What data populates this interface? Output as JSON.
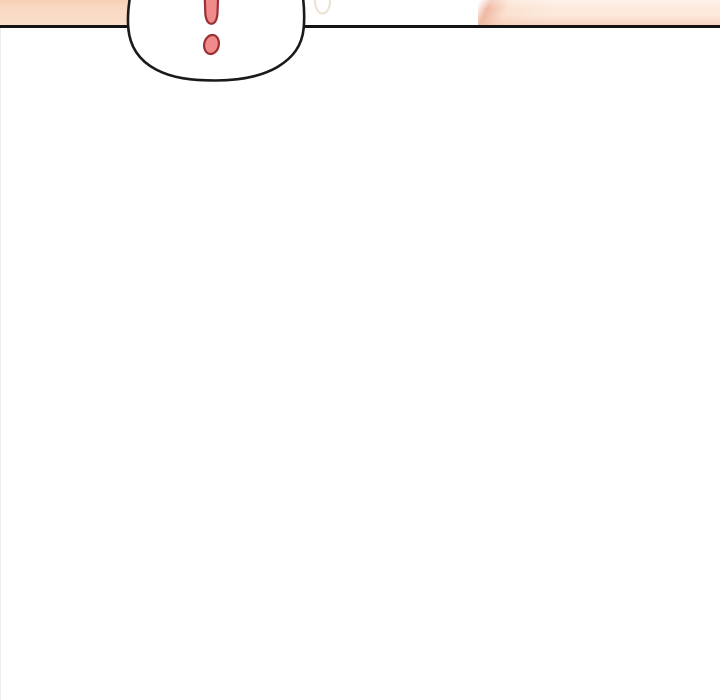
{
  "scene": {
    "type": "webtoon-comic-panel-excerpt",
    "description": "Bottom edge of a comic panel: skin-toned artwork above a black panel border line, a white outlined speech bubble overlapping the border containing a red exclamation mark, a faint oval art detail at the top, and blank white space below.",
    "speech_bubble": {
      "symbol": "!",
      "symbol_name": "exclamation-mark"
    }
  },
  "colors": {
    "background": "#ffffff",
    "panel-line": "#141414",
    "bubble-fill": "#ffffff",
    "bubble-stroke": "#1a1a1a",
    "exclaim-fill": "#f18a8a",
    "exclaim-stroke": "#9a3134",
    "skin-left-deep": "#f5cfb2",
    "skin-left-top": "#f8d7bf",
    "skin-left-bottom": "#fbdfca",
    "skin-right-edge": "#f0b9a4",
    "skin-right-mid": "#fbe2d1",
    "skin-right-light": "#fdeadd",
    "faint-oval-stroke": "#eee0d1",
    "page-edge-line": "#efeded"
  }
}
